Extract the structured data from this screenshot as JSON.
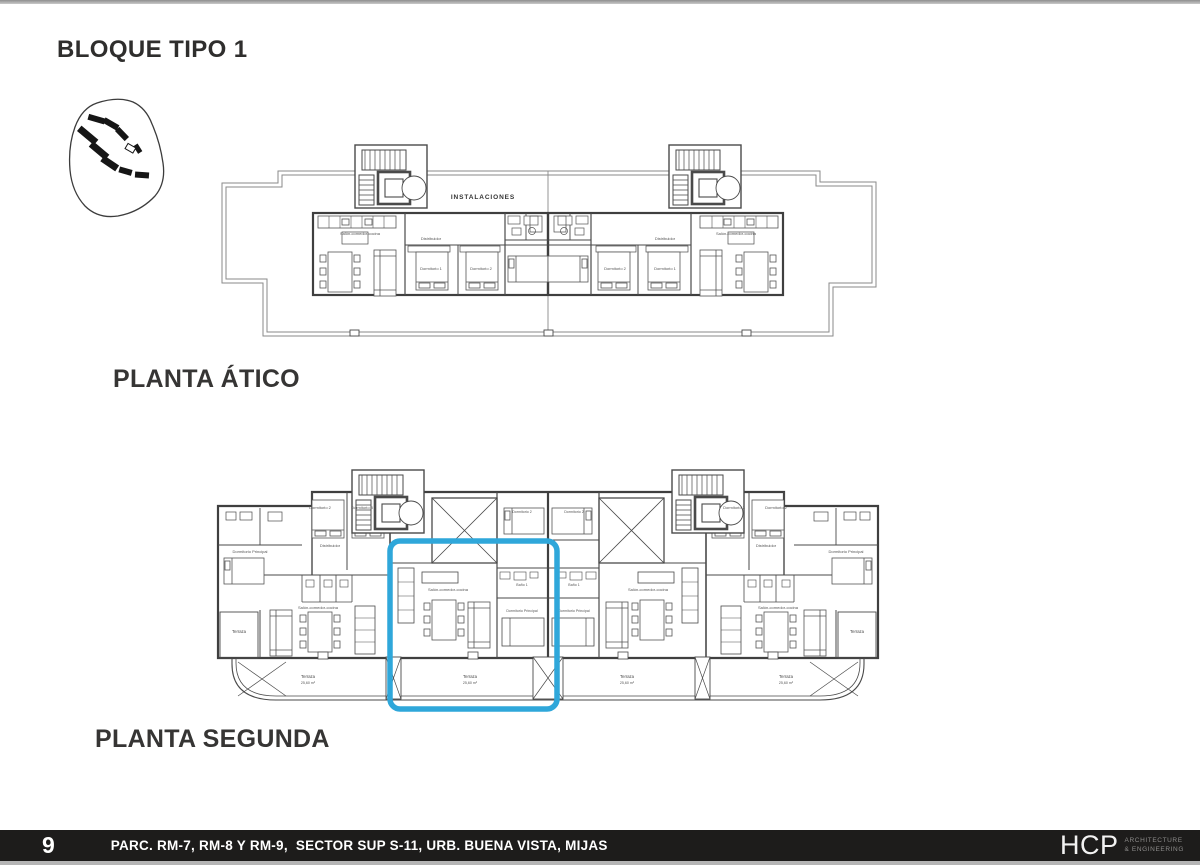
{
  "page": {
    "title": "BLOQUE TIPO 1"
  },
  "plans": {
    "atico": {
      "label": "PLANTA ÁTICO",
      "instalaciones": "INSTALACIONES"
    },
    "segunda": {
      "label": "PLANTA SEGUNDA",
      "highlight_color": "#2fa7da"
    },
    "room_labels": {
      "salon": "Salón-comedor-cocina",
      "dormitorio1": "Dormitorio 1",
      "dormitorio2": "Dormitorio 2",
      "dormitorio3": "Dormitorio 3",
      "dormitorio_ppal": "Dormitorio Principal",
      "bano1": "Baño 1",
      "distribuidor": "Distribuidor",
      "terraza": "Terraza",
      "terraza_area": "25,60 m²"
    }
  },
  "footer": {
    "page_number": "9",
    "project": "PARC. RM-7, RM-8 Y RM-9,  SECTOR SUP S-11, URB. BUENA VISTA, MIJAS",
    "logo": {
      "name": "HCP",
      "sub1": "ARCHITECTURE",
      "sub2": "& ENGINEERING"
    }
  }
}
